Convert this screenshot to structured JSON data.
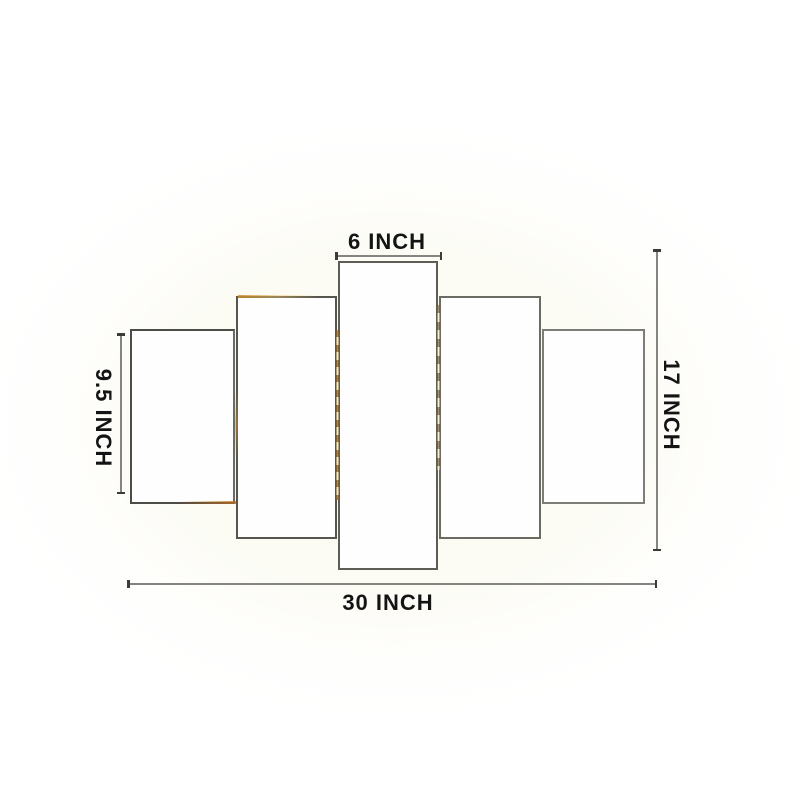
{
  "colors": {
    "page_background": "#ffffff",
    "canvas_tint": "#fbfaf1",
    "panel_fill": "#fefefe",
    "panel_border": "#55544c",
    "dimension_line": "#85847e",
    "label_text": "#141414",
    "gold_accent": "#c8882e"
  },
  "diagram": {
    "panel_count": 5,
    "dimensions": {
      "center_panel_width": {
        "label": "6 INCH",
        "value": "6",
        "unit": "INCH"
      },
      "side_panel_height": {
        "label": "9.5 INCH",
        "value": "9.5",
        "unit": "INCH"
      },
      "total_height": {
        "label": "17 INCH",
        "value": "17",
        "unit": "INCH"
      },
      "total_width": {
        "label": "30 INCH",
        "value": "30",
        "unit": "INCH"
      }
    }
  }
}
